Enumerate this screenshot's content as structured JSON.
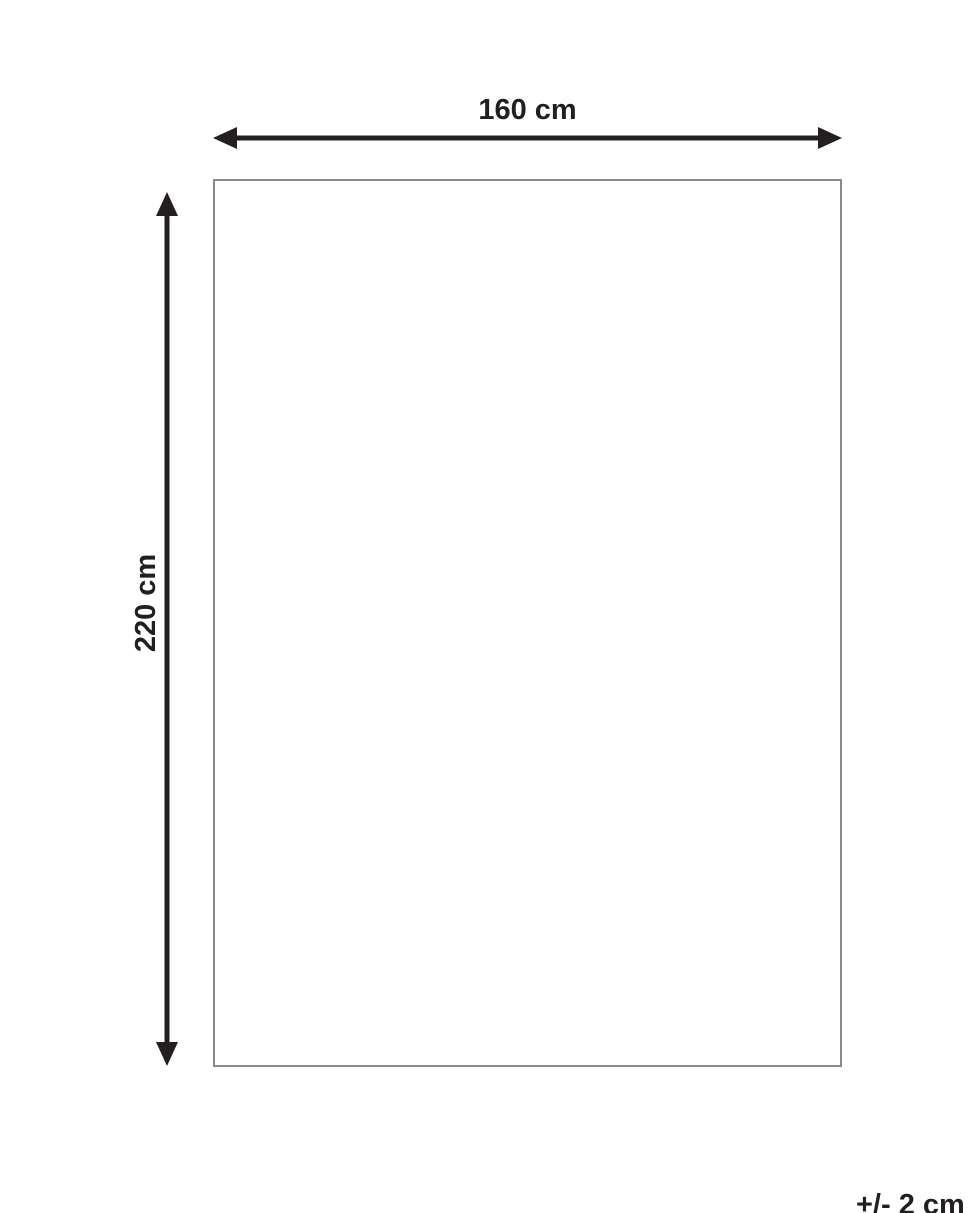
{
  "diagram": {
    "title": "product-dimension-diagram",
    "shape": "rectangle",
    "width_label": "160 cm",
    "height_label": "220 cm",
    "tolerance_label": "+/- 2 cm",
    "colors": {
      "arrow": "#231f20",
      "outline": "#8a8a8a",
      "background": "#ffffff"
    }
  }
}
